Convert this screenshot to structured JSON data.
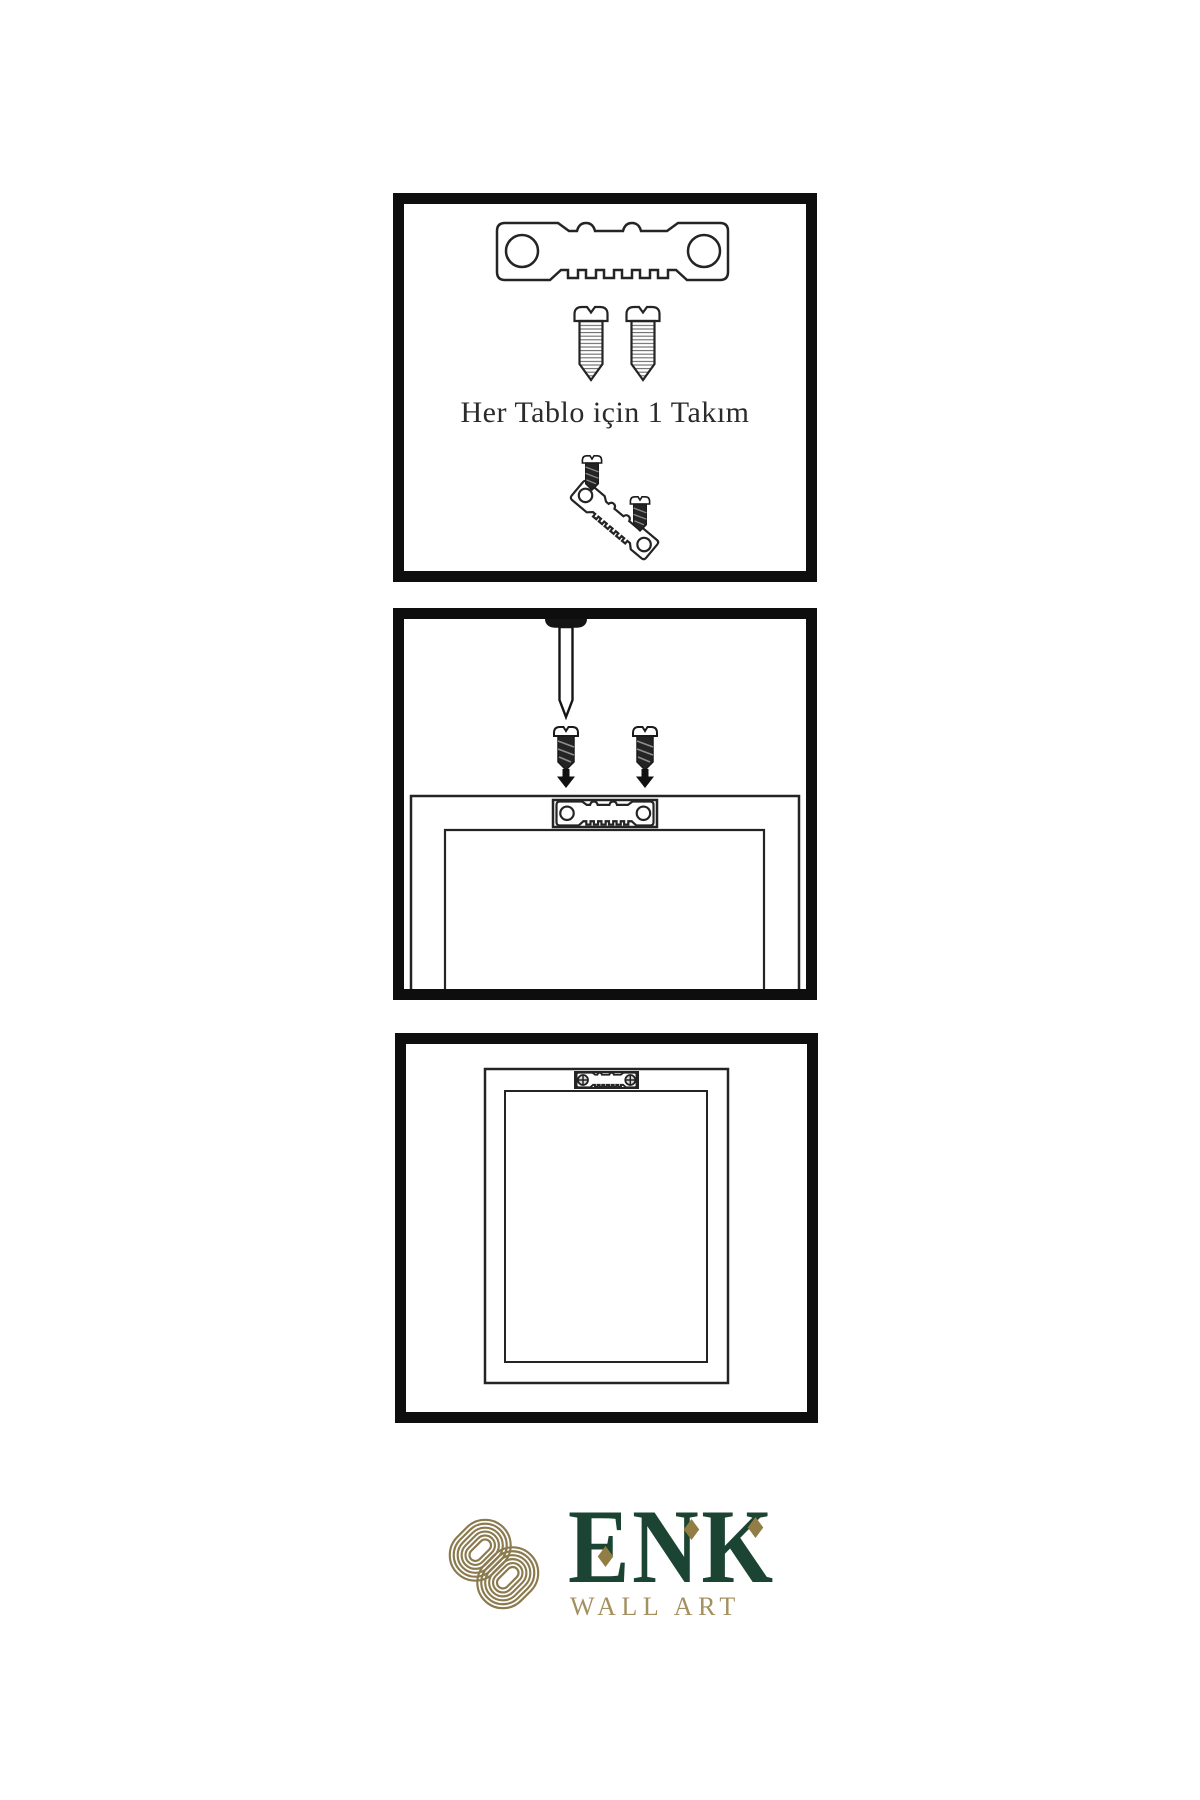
{
  "colors": {
    "panel_border": "#0e0e0e",
    "line": "#242424",
    "knot_gold": "#8a7a4d",
    "logo_green": "#1c4433",
    "wallart_gold": "#a3905f",
    "diamond_gold": "#927d45",
    "background": "#ffffff"
  },
  "step1": {
    "caption": "Her Tablo için 1 Takım",
    "icons": [
      "sawtooth-hanger-icon",
      "screw-icon",
      "screw-icon",
      "screw-into-hanger-icon"
    ]
  },
  "step2": {
    "icons": [
      "nail-icon",
      "screw-icon",
      "screw-icon",
      "down-arrow-icon",
      "down-arrow-icon",
      "frame-back-icon",
      "installed-hanger-icon"
    ]
  },
  "step3": {
    "icons": [
      "frame-back-icon",
      "mounted-hanger-icon"
    ]
  },
  "logo": {
    "name": "ENK",
    "subtitle": "WALL ART"
  }
}
